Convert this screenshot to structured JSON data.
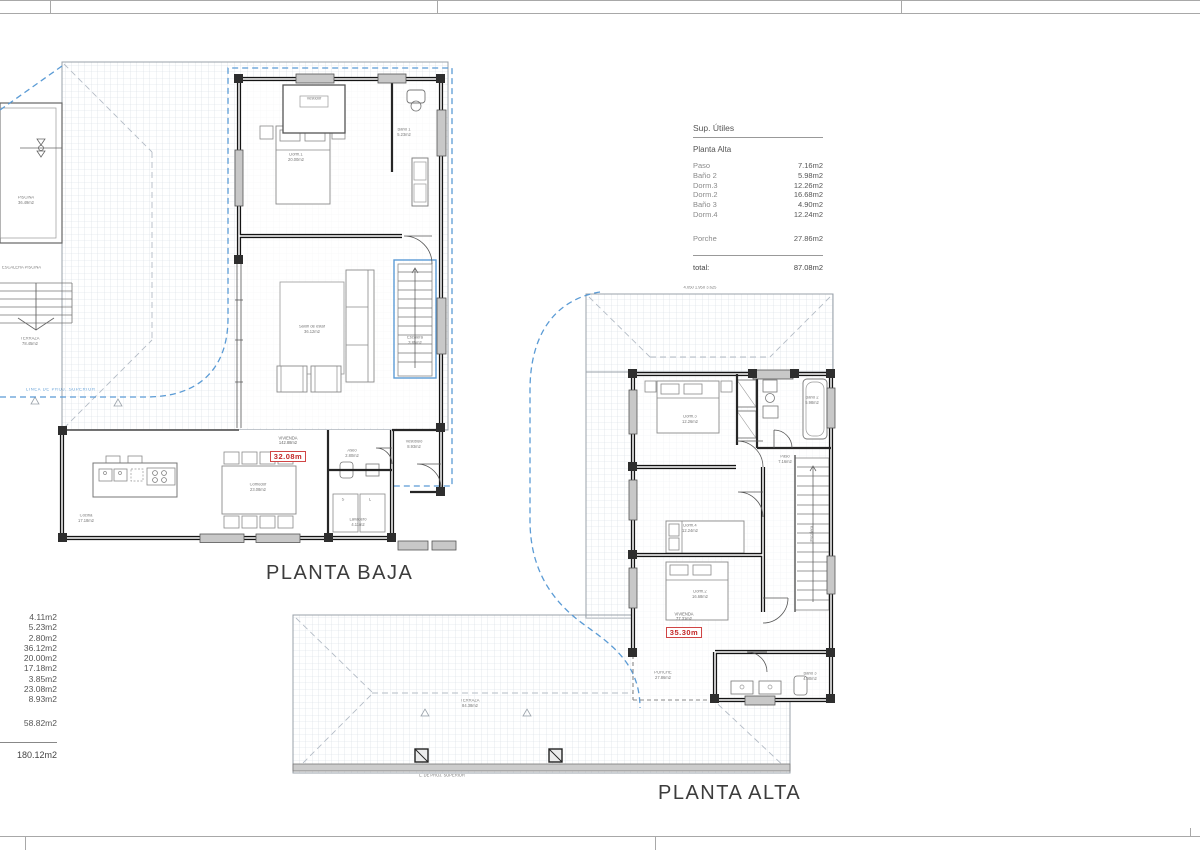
{
  "colors": {
    "accent_blue": "#5b9bd5",
    "badge_red": "#c22626",
    "wall": "#141414"
  },
  "tables": {
    "sup_utiles": {
      "title": "Sup. Útiles",
      "subtitle": "Planta Alta",
      "rows": [
        {
          "label": "Paso",
          "value": "7.16m2"
        },
        {
          "label": "Baño 2",
          "value": "5.98m2"
        },
        {
          "label": "Dorm.3",
          "value": "12.26m2"
        },
        {
          "label": "Dorm.2",
          "value": "16.68m2"
        },
        {
          "label": "Baño 3",
          "value": "4.90m2"
        },
        {
          "label": "Dorm.4",
          "value": "12.24m2"
        }
      ],
      "porche": {
        "label": "Porche",
        "value": "27.86m2"
      },
      "total": {
        "label": "total:",
        "value": "87.08m2"
      }
    },
    "baja_areas": {
      "values": [
        "4.11m2",
        "5.23m2",
        "2.80m2",
        "36.12m2",
        "20.00m2",
        "17.18m2",
        "3.85m2",
        "23.08m2",
        "8.93m2"
      ],
      "subtotal": "58.82m2",
      "total": "180.12m2"
    }
  },
  "plans": {
    "baja": {
      "title": "PLANTA BAJA",
      "projection_label": "LINEA DE PROJ. SUPERIOR",
      "pool_steps_note": "ESCALERA PISCINA",
      "vivienda": {
        "label": "VIVIENDA",
        "area": "142.88m2",
        "badge": "32.08m"
      },
      "rooms": {
        "piscina": {
          "name": "PISCINA",
          "area": "36.49m2"
        },
        "terraza": {
          "name": "TERRAZA",
          "area": "78.45m2"
        },
        "dorm1": {
          "name": "Dorm.1",
          "area": "20.00m2"
        },
        "vestidor": {
          "name": "Vestidor"
        },
        "bano1": {
          "name": "Baño 1",
          "area": "5.23m2"
        },
        "salon": {
          "name": "Salón de estar",
          "area": "36.12m2"
        },
        "escalera": {
          "name": "Escalera",
          "area": "3.85m2"
        },
        "cocina": {
          "name": "Cocina",
          "area": "17.18m2"
        },
        "comedor": {
          "name": "Comedor",
          "area": "23.08m2"
        },
        "vestibulo": {
          "name": "Vestíbulo",
          "area": "8.93m2"
        },
        "aseo": {
          "name": "Aseo",
          "area": "2.80m2"
        },
        "lavadero": {
          "name": "Lavadero",
          "area": "4.11m2"
        },
        "s": "S",
        "l": "L"
      }
    },
    "alta": {
      "title": "PLANTA ALTA",
      "dim_top": "4.050      1.950      3.625",
      "projection_note": "L. DE PROJ. SUPERIOR",
      "vivienda": {
        "label": "VIVIENDA",
        "area": "77.31m2",
        "badge": "35.30m"
      },
      "rooms": {
        "dorm3": {
          "name": "Dorm.3",
          "area": "12.26m2"
        },
        "bano2": {
          "name": "Baño 2",
          "area": "5.98m2"
        },
        "paso": {
          "name": "Paso",
          "area": "7.16m2"
        },
        "dorm4": {
          "name": "Dorm.4",
          "area": "12.24m2"
        },
        "dorm2": {
          "name": "Dorm.2",
          "area": "16.68m2"
        },
        "bano3": {
          "name": "Baño 3",
          "area": "4.90m2"
        },
        "escalera": {
          "name": "Escalera"
        },
        "porche": {
          "name": "PORCHE",
          "area": "27.86m2"
        },
        "terraza": {
          "name": "TERRAZA",
          "area": "84.38m2"
        }
      }
    }
  }
}
